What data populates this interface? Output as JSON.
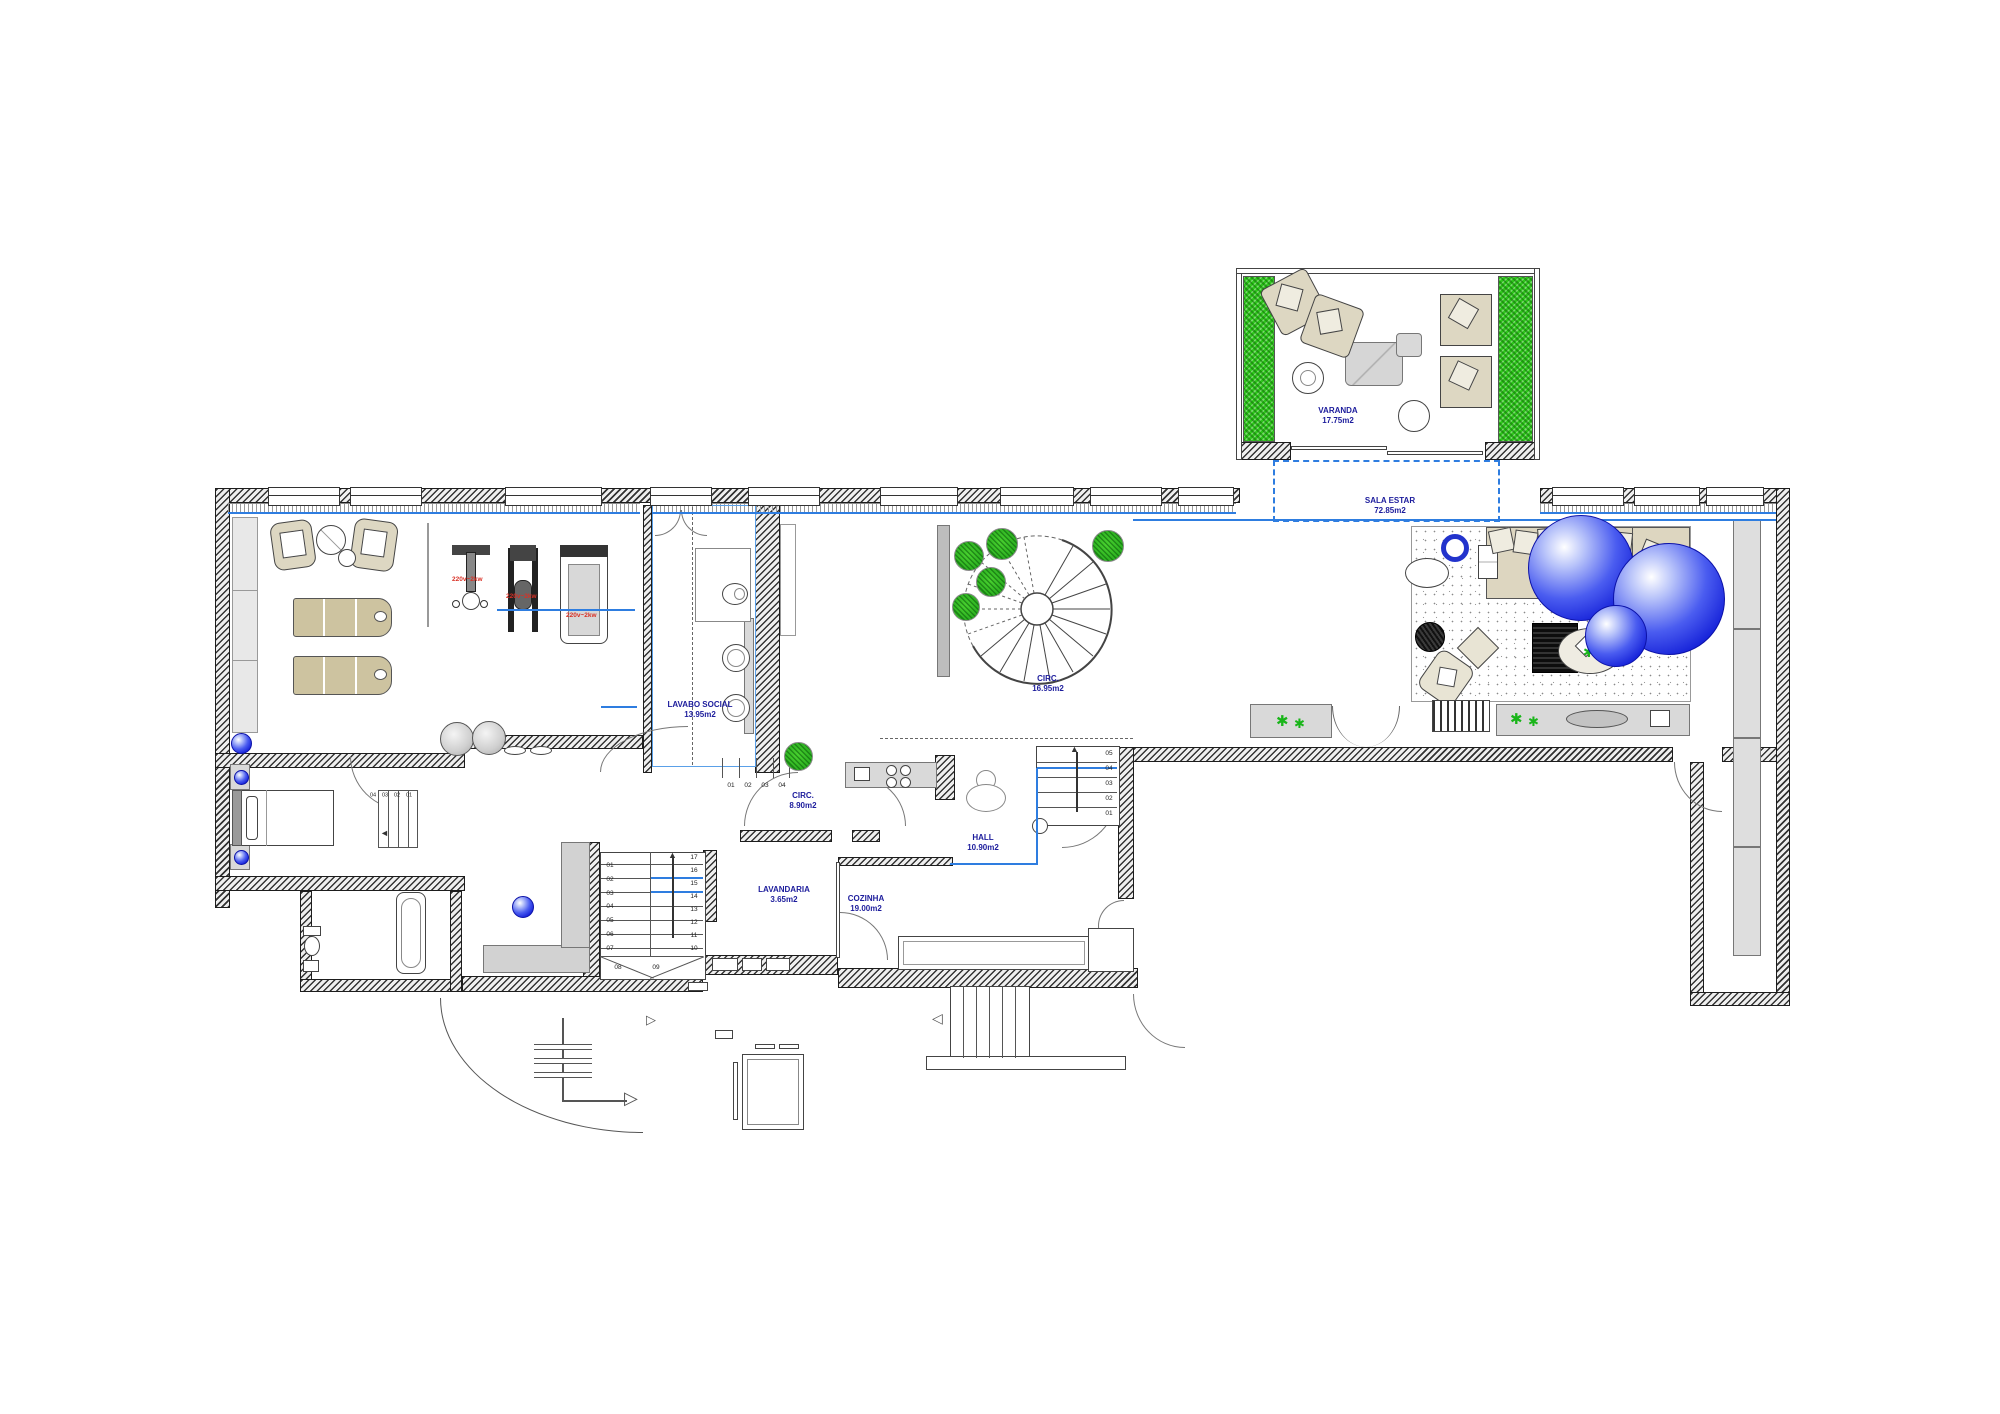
{
  "drawing": {
    "type": "apartment-floor-plan"
  },
  "colors": {
    "room_label": "#1c1c9c",
    "datum_blue": "#2e7de0",
    "plant_green": "#19b519",
    "power_red": "#d93025",
    "wall_hatch": "#333333",
    "furniture_beige": "#cdc3a0",
    "sphere_blue": "#1420d8"
  },
  "rooms": {
    "varanda": {
      "name": "VARANDA",
      "area": "17.75m2"
    },
    "sala_estar": {
      "name": "SALA ESTAR",
      "area": "72.85m2"
    },
    "lavabo_social": {
      "name": "LAVABO SOCIAL",
      "area": "13.95m2"
    },
    "circ_main": {
      "name": "CIRC.",
      "area": "16.95m2"
    },
    "circ_small": {
      "name": "CIRC.",
      "area": "8.90m2"
    },
    "hall": {
      "name": "HALL",
      "area": "10.90m2"
    },
    "lavandaria": {
      "name": "LAVANDARIA",
      "area": "3.65m2"
    },
    "cozinha": {
      "name": "COZINHA",
      "area": "19.00m2"
    }
  },
  "equipment_labels": {
    "power_1": "220v~2kw",
    "power_2": "220v~2kw",
    "power_3": "220v~2kw"
  },
  "stairs": {
    "main": {
      "left": [
        "01",
        "02",
        "03",
        "04",
        "05",
        "06",
        "07"
      ],
      "right": [
        "17",
        "16",
        "15",
        "14",
        "13",
        "12",
        "11",
        "10"
      ],
      "winders": [
        "08",
        "09"
      ]
    },
    "hall": [
      "05",
      "04",
      "03",
      "02",
      "01"
    ],
    "bedroom": [
      "04",
      "03",
      "02",
      "01"
    ],
    "lavabo": [
      "01",
      "02",
      "03",
      "04"
    ]
  }
}
